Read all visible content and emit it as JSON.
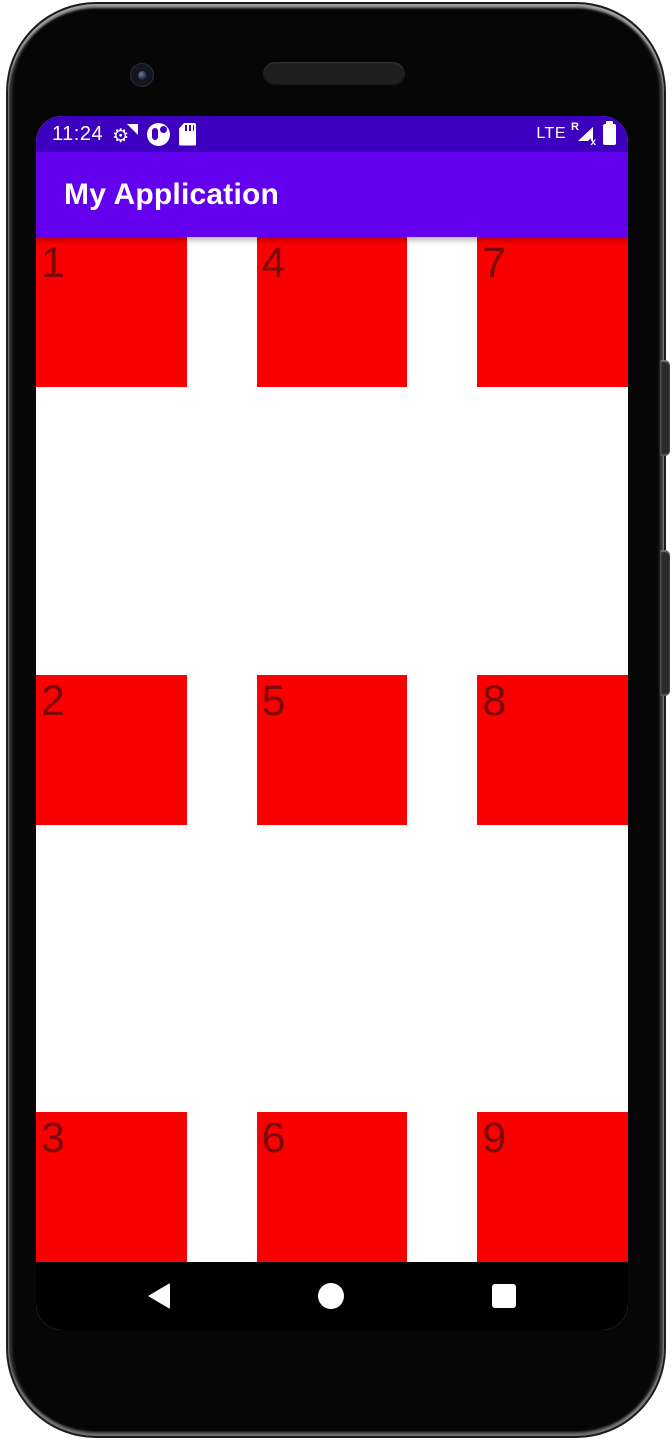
{
  "status_bar": {
    "time": "11:24",
    "left_icons": [
      {
        "name": "setup-gear-icon",
        "glyph": "⚙"
      },
      {
        "name": "storage-status-icon"
      },
      {
        "name": "sd-card-icon"
      }
    ],
    "network": {
      "type_label": "LTE",
      "roaming_superscript": "R",
      "no_connection_mark": "x"
    },
    "battery": {
      "level": "full"
    }
  },
  "app_bar": {
    "title": "My Application"
  },
  "content_grid": {
    "rows": 3,
    "columns": 3,
    "cells": [
      {
        "label": "1"
      },
      {
        "label": "4"
      },
      {
        "label": "7"
      },
      {
        "label": "2"
      },
      {
        "label": "5"
      },
      {
        "label": "8"
      },
      {
        "label": "3"
      },
      {
        "label": "6"
      },
      {
        "label": "9"
      }
    ]
  },
  "nav_bar": {
    "icons": [
      "back",
      "home",
      "recents"
    ]
  },
  "colors": {
    "status_bar_bg": "#3D00BE",
    "app_bar_bg": "#6200EE",
    "tile_red": "#FB0000",
    "tile_number": "#7A0A0A"
  }
}
